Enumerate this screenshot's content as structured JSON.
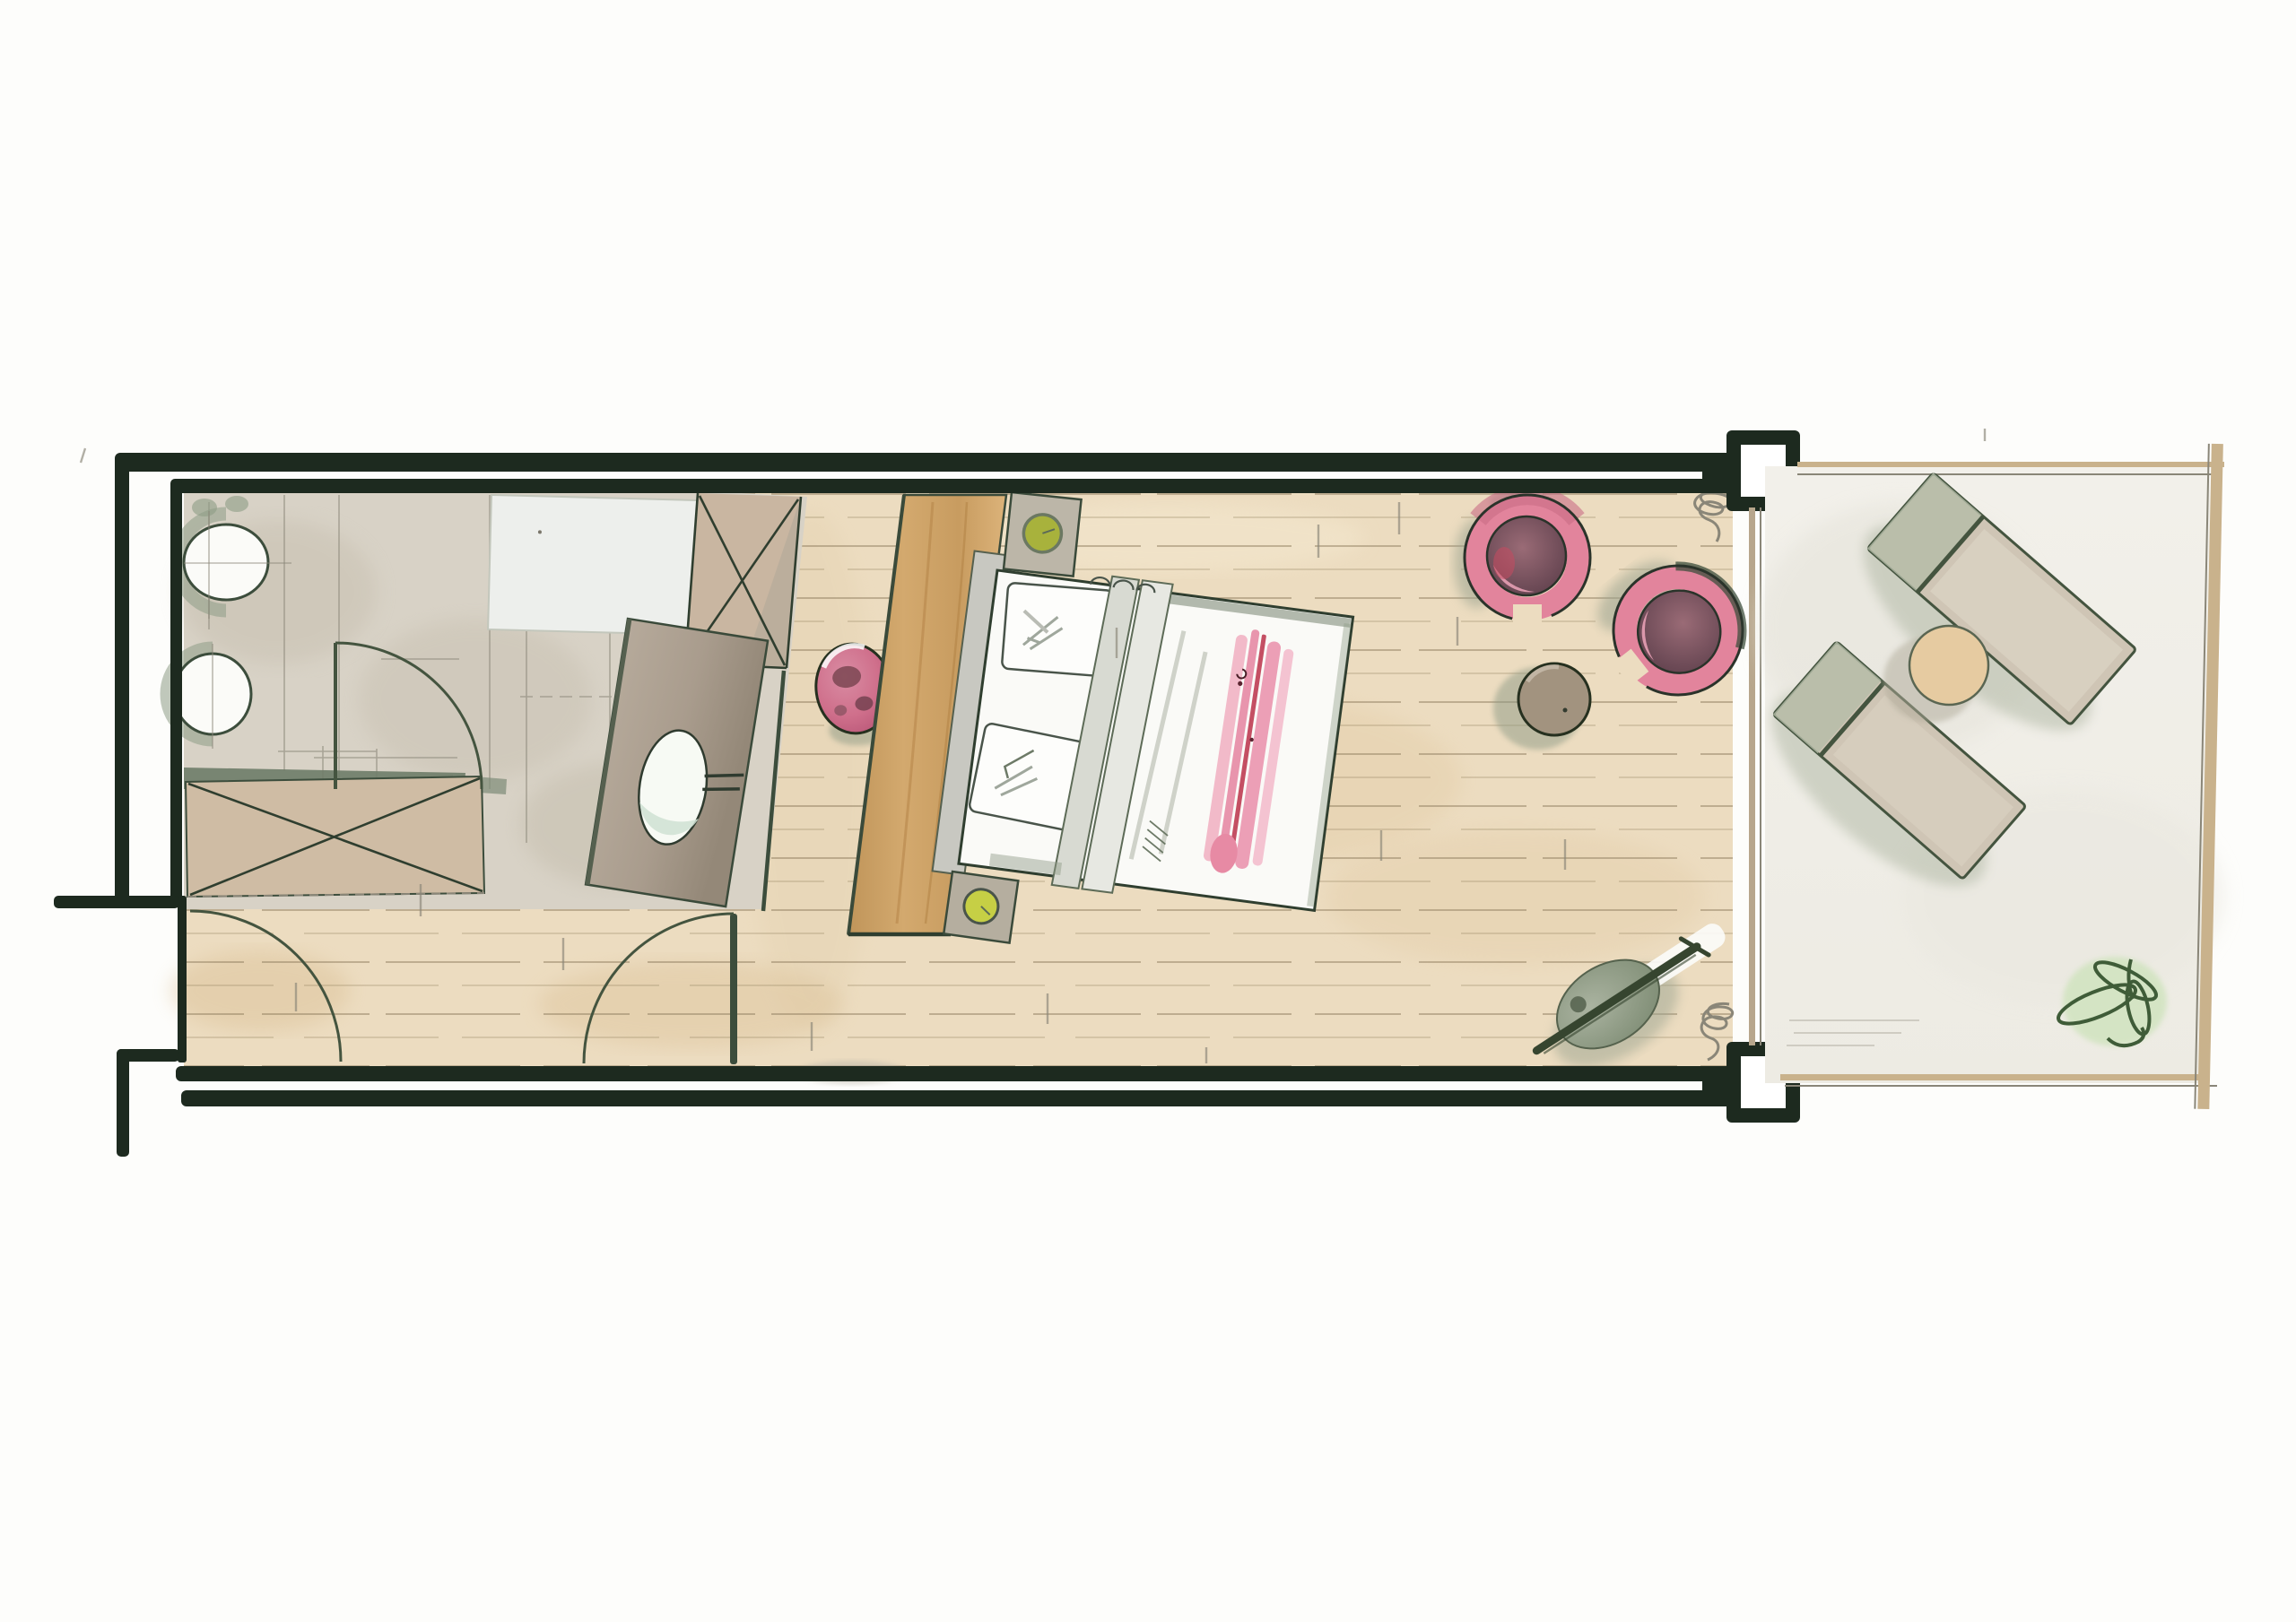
{
  "document": {
    "kind": "hand-drawn watercolor floor plan",
    "subject": "elongated guest room with bathroom, bedroom and terrace",
    "visible_text": []
  },
  "palette": {
    "wall": "#1d2a1f",
    "ink": "#2f3e2f",
    "pencil": "#8a8678",
    "wood": "#ecdcc0",
    "woodline": "#8c7a5c",
    "bath": "#d8d2c6",
    "tan": "#cdbaa3",
    "band": "#6e7c68",
    "tub": "#edefec",
    "vanity": "#a99c8d",
    "basinmint": "#cfe0d2",
    "stool": "#cf6f8b",
    "plum": "#6f4c58",
    "pinkring": "#e2849c",
    "stripepink": "#ec9fb6",
    "stripered": "#c44f63",
    "lampolive": "#a8b23c",
    "lampyellow": "#c6cf45",
    "tablebrown": "#a2937f",
    "shadowgreen": "#8d9a85",
    "panel": "#cfa167",
    "terrace": "#f1efe9",
    "bordertan": "#c9b28c",
    "lounger": "#cfc5b5",
    "loungerframe": "#44543f",
    "plant": "#3f5c38",
    "plantwash": "#cfe3bd",
    "bedwhite": "#fafaf7",
    "glass": "#b7a68c",
    "paper": "#fdfdfb"
  },
  "rooms": [
    {
      "name": "bathroom",
      "items": [
        "toilet",
        "bidet",
        "bathtub",
        "shower",
        "vanity-with-basin",
        "pink-stool",
        "wardrobe",
        "doors"
      ]
    },
    {
      "name": "bedroom",
      "items": [
        "wood-headboard-panel",
        "double-bed",
        "nightstand-top",
        "nightstand-bottom",
        "pink-armchair-1",
        "pink-armchair-2",
        "round-side-table",
        "floor-object"
      ]
    },
    {
      "name": "terrace",
      "items": [
        "lounger-1",
        "lounger-2",
        "lounger-table",
        "plant"
      ]
    }
  ]
}
